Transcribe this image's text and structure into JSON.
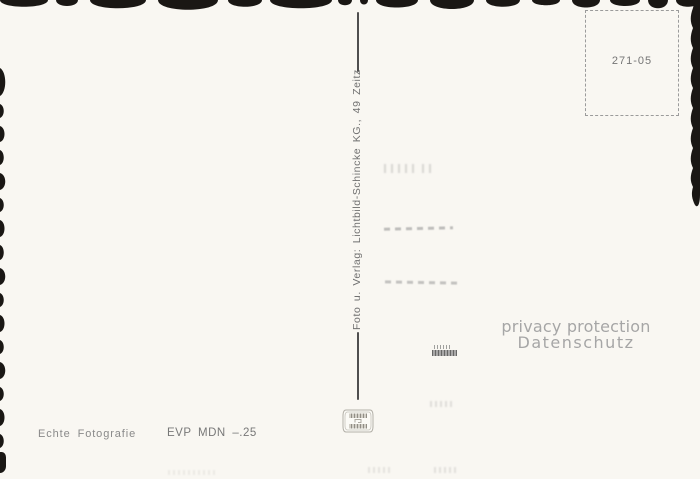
{
  "colors": {
    "paper": "#f9f7f2",
    "deckle_edge": "#1a1714",
    "print_ink": "#707070",
    "watermark_gray": "#a6a6a6"
  },
  "stamp_box": {
    "code": "271-05"
  },
  "center_divider": {
    "imprint": "Foto u. Verlag: Lichtbild-Schincke KG., 49 Zeitz"
  },
  "footer": {
    "photo_type_label": "Echte Fotografie",
    "price_label": "EVP MDN –.25"
  },
  "watermark": {
    "line1": "privacy protection",
    "line2": "Datenschutz"
  }
}
